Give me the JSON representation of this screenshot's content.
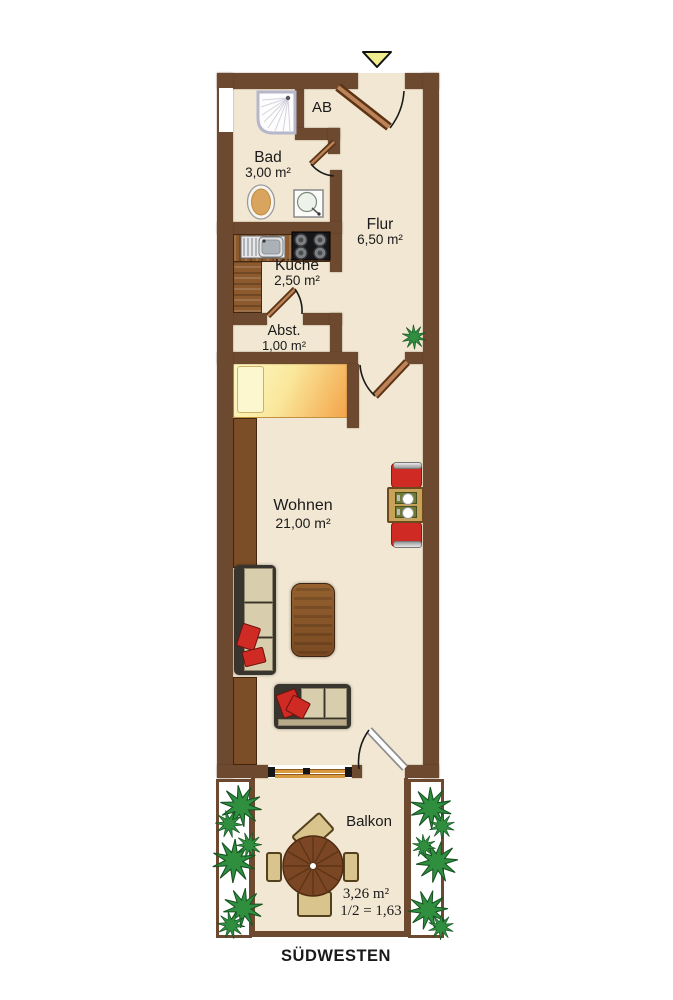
{
  "colors": {
    "wall": "#6d4930",
    "floor": "#f2e7d2",
    "wood": "#8d5a2e",
    "wooddark": "#7c4e27",
    "door": "#a5633a",
    "dooredge": "#5d3315",
    "plant": "#2f8f3e",
    "plantdark": "#175223",
    "arrow": "#f1ed8e",
    "red": "#cf2b24",
    "cushion": "#d8cdad",
    "frame": "#38342e",
    "tan": "#d9c48e",
    "tabletan": "#c9a25a",
    "mat": "#6f7a38",
    "text": "#1a1a1a"
  },
  "rooms": {
    "ab": {
      "label": "AB"
    },
    "bad": {
      "label": "Bad",
      "area": "3,00 m²"
    },
    "flur": {
      "label": "Flur",
      "area": "6,50 m²"
    },
    "kueche": {
      "label": "Küche",
      "area": "2,50 m²"
    },
    "abst": {
      "label": "Abst.",
      "area": "1,00 m²"
    },
    "wohnen": {
      "label": "Wohnen",
      "area": "21,00 m²"
    },
    "balkon": {
      "label": "Balkon",
      "area": "3,26 m²",
      "half_area": "1/2 = 1,63"
    }
  },
  "compass": {
    "label": "SÜDWESTEN"
  }
}
